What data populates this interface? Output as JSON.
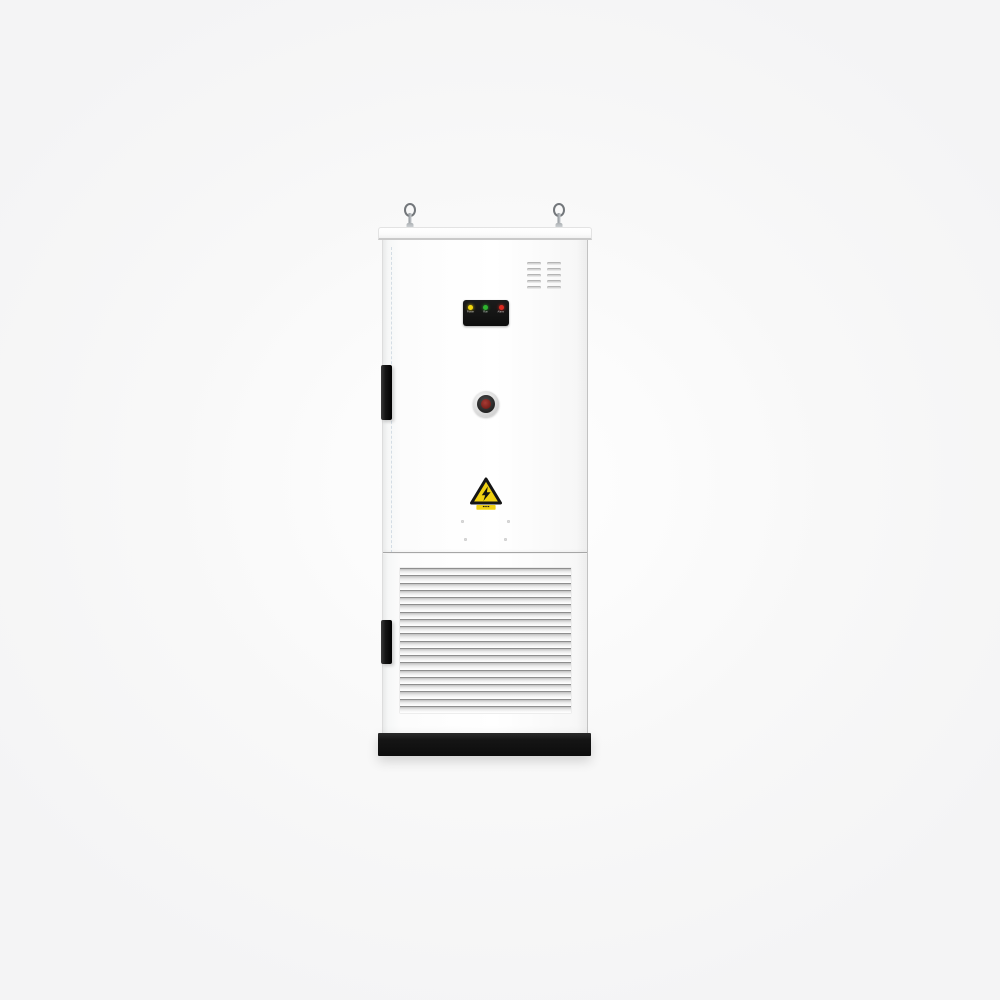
{
  "meta": {
    "description": "Product photo of a white industrial power/battery cabinet on a light gray background"
  },
  "colors": {
    "background": "#f5f5f6",
    "cabinet_body": "#ffffff",
    "base_plinth": "#141414",
    "handle": "#161616",
    "panel_background": "#131313",
    "warning_yellow": "#f0d011"
  },
  "cabinet": {
    "lifting_eyes": {
      "count": 2
    },
    "vent": {
      "rows": 5,
      "columns": 2
    },
    "status_panel": {
      "leds": [
        {
          "id": "power",
          "color": "#f2d70e",
          "label": "Power"
        },
        {
          "id": "run",
          "color": "#2fb32f",
          "label": "Run"
        },
        {
          "id": "alarm",
          "color": "#dd2a20",
          "label": "Alarm"
        }
      ]
    },
    "indicator_button": {
      "bezel_color": "#d9d9d9",
      "ring_color": "#262626",
      "core_color": "#7a201b"
    },
    "warning_sticker": {
      "symbol": "high-voltage-lightning",
      "triangle_fill": "#f0d011",
      "border_color": "#151515",
      "caption": "▪▪▪▪"
    },
    "door_handles": {
      "count": 2
    },
    "louver_grille": {
      "slats": 20
    },
    "screws": {
      "count": 4
    }
  }
}
